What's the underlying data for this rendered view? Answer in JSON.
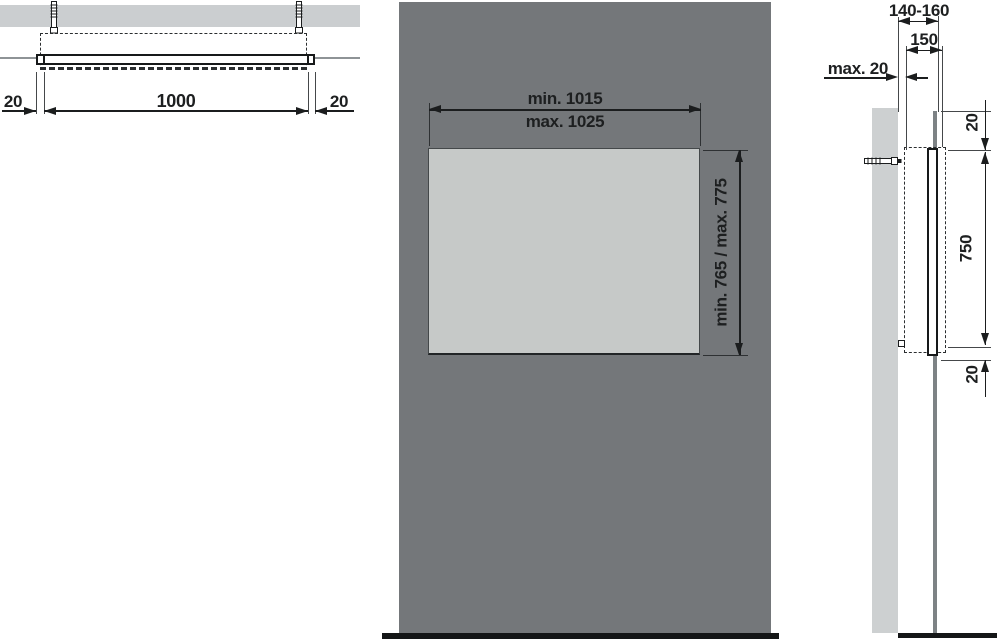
{
  "colors": {
    "panel_gray": "#74777a",
    "mirror_gray": "#c6c9c8",
    "wall_gray": "#cdd0d1",
    "line_dark": "#1b1d1e",
    "floor_black": "#141617",
    "wall_edge_gray": "#8e9396",
    "panel_edge_gray": "#7d8285"
  },
  "top_view": {
    "label_offset_left": "20",
    "label_length": "1000",
    "label_offset_right": "20"
  },
  "front_view": {
    "label_width_min": "min. 1015",
    "label_width_max": "max. 1025",
    "label_height": "min. 765 / max. 775"
  },
  "side_view": {
    "label_wall_distance": "140-160",
    "label_depth": "150",
    "label_gap": "max. 20",
    "label_top_offset": "20",
    "label_frame_height": "750",
    "label_bottom_offset": "20"
  }
}
